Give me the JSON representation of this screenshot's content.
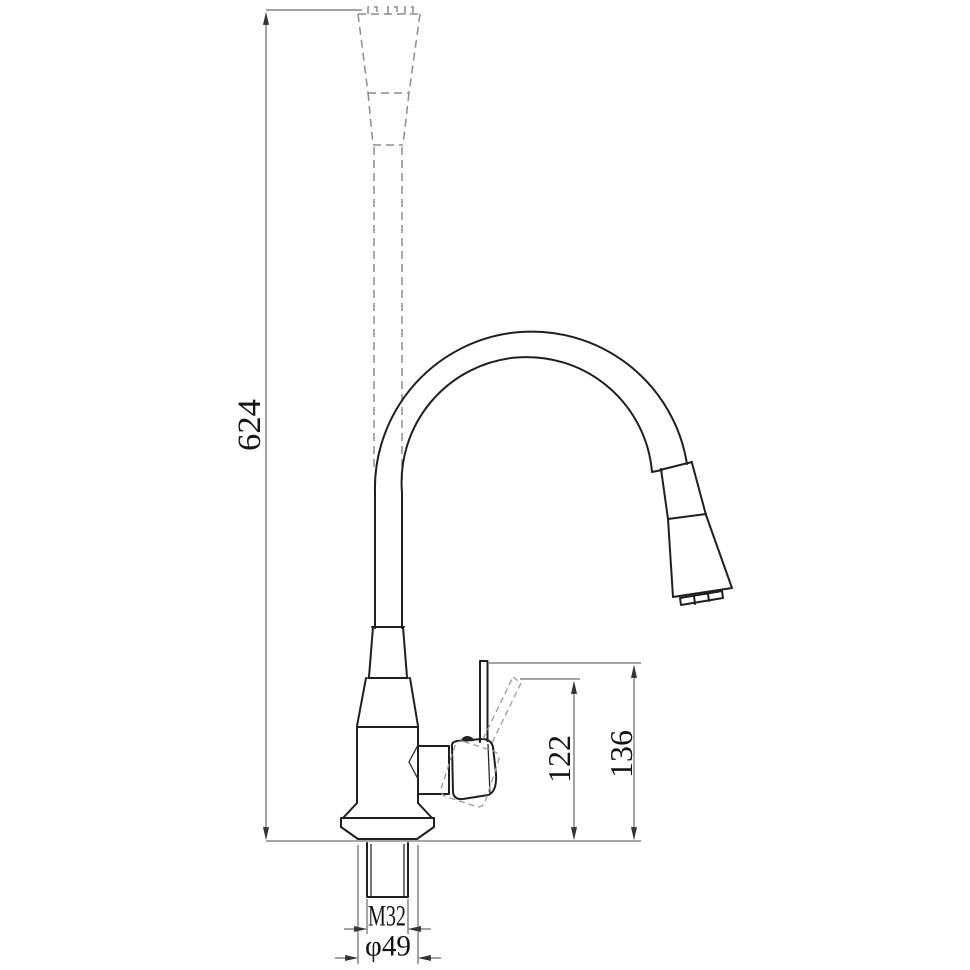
{
  "drawing": {
    "subject": "pull-down kitchen faucet, side elevation technical drawing",
    "background_color": "#ffffff",
    "outline_color": "#1f1f1f",
    "dimension_line_color": "#4a4a4a",
    "dashed_alt_position_color": "#8c8c8c"
  },
  "dimensions": {
    "overall_height": "624",
    "handle_tip_to_counter": "122",
    "handle_top_to_counter": "136",
    "inlet_thread": "M32",
    "base_diameter": "φ49"
  }
}
